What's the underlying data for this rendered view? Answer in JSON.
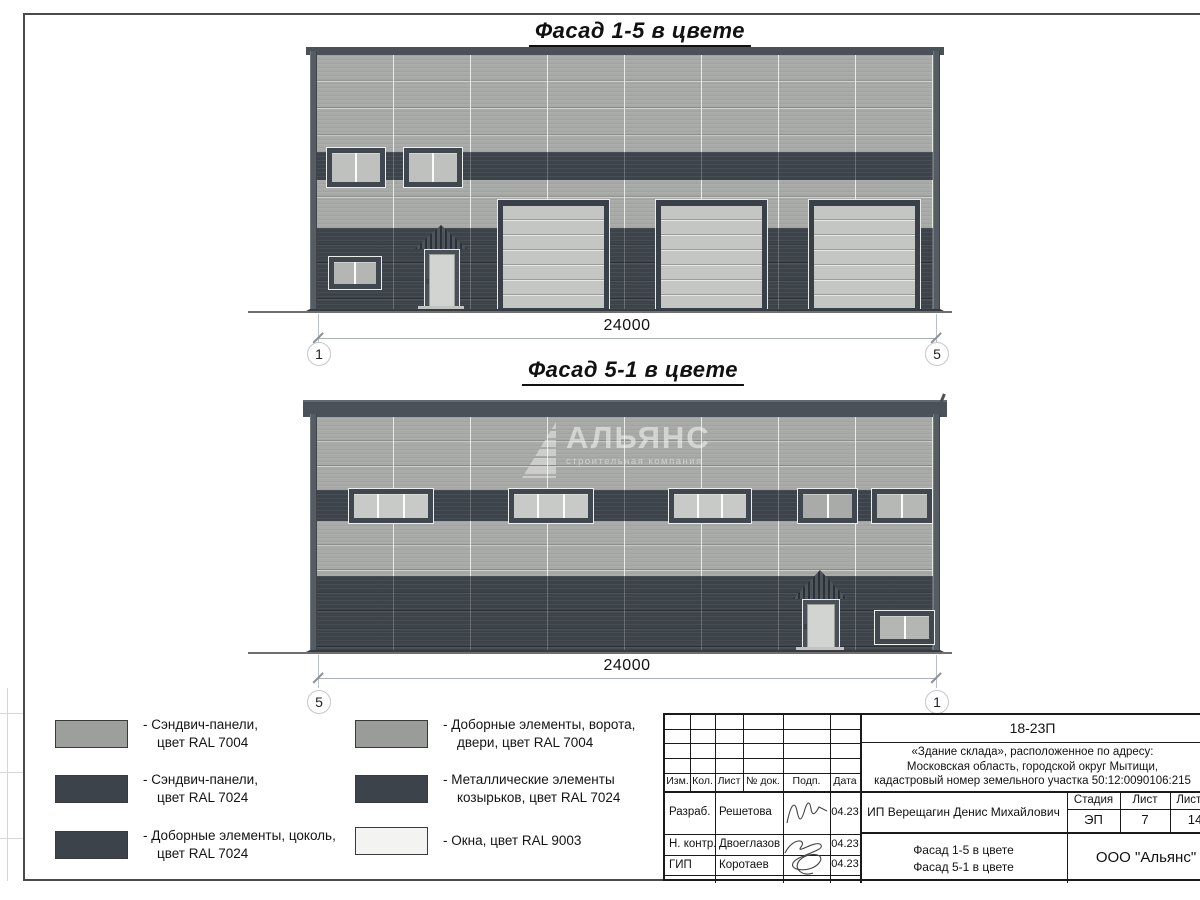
{
  "titles": {
    "facade_top": "Фасад 1-5 в цвете",
    "facade_bottom": "Фасад 5-1 в цвете"
  },
  "dimensions": {
    "top": {
      "value": "24000",
      "left_axis": "1",
      "right_axis": "5"
    },
    "bottom": {
      "value": "24000",
      "left_axis": "5",
      "right_axis": "1"
    }
  },
  "watermark": {
    "name": "АЛЬЯНС",
    "subtitle": "строительная компания"
  },
  "legend": {
    "items": [
      {
        "color": "#9c9f9c",
        "lines": [
          "- Сэндвич-панели,",
          "цвет RAL 7004"
        ]
      },
      {
        "color": "#3d434a",
        "lines": [
          "- Сэндвич-панели,",
          "цвет RAL 7024"
        ]
      },
      {
        "color": "#3d434a",
        "lines": [
          "- Доборные элементы, цоколь,",
          "цвет RAL 7024"
        ]
      },
      {
        "color": "#999c99",
        "lines": [
          "- Доборные элементы, ворота,",
          "двери, цвет RAL 7004"
        ]
      },
      {
        "color": "#3d434a",
        "lines": [
          "- Металлические элементы",
          "козырьков, цвет RAL 7024"
        ]
      },
      {
        "color": "#f3f4f2",
        "lines": [
          "- Окна, цвет RAL 9003",
          ""
        ]
      }
    ]
  },
  "title_block": {
    "project_code": "18-23П",
    "address_lines": [
      "«Здание склада», расположенное по адресу:",
      "Московская область, городской округ Мытищи,",
      "кадастровый номер земельного участка 50:12:0090106:215"
    ],
    "columns": [
      "Изм.",
      "Кол.",
      "Лист",
      "№ док.",
      "Подп.",
      "Дата"
    ],
    "rows": [
      {
        "role": "Разраб.",
        "name": "Решетова",
        "date": "04.23"
      },
      {
        "role": "Н. контр.",
        "name": "Двоеглазов",
        "date": "04.23"
      },
      {
        "role": "ГИП",
        "name": "Коротаев",
        "date": "04.23"
      }
    ],
    "client": "ИП Верещагин Денис Михайлович",
    "stage_label": "Стадия",
    "sheet_label": "Лист",
    "sheets_label": "Листов",
    "stage": "ЭП",
    "sheet": "7",
    "sheets": "14",
    "sheet_title_lines": [
      "Фасад 1-5 в цвете",
      "Фасад 5-1 в цвете"
    ],
    "company": "ООО \"Альянс\""
  },
  "colors": {
    "ral_7004_panel": "#a8aaa7",
    "ral_7024_panel": "#3d434a",
    "ral_9003_window": "#f3f4f2",
    "frame_line": "#4a4a4a"
  }
}
